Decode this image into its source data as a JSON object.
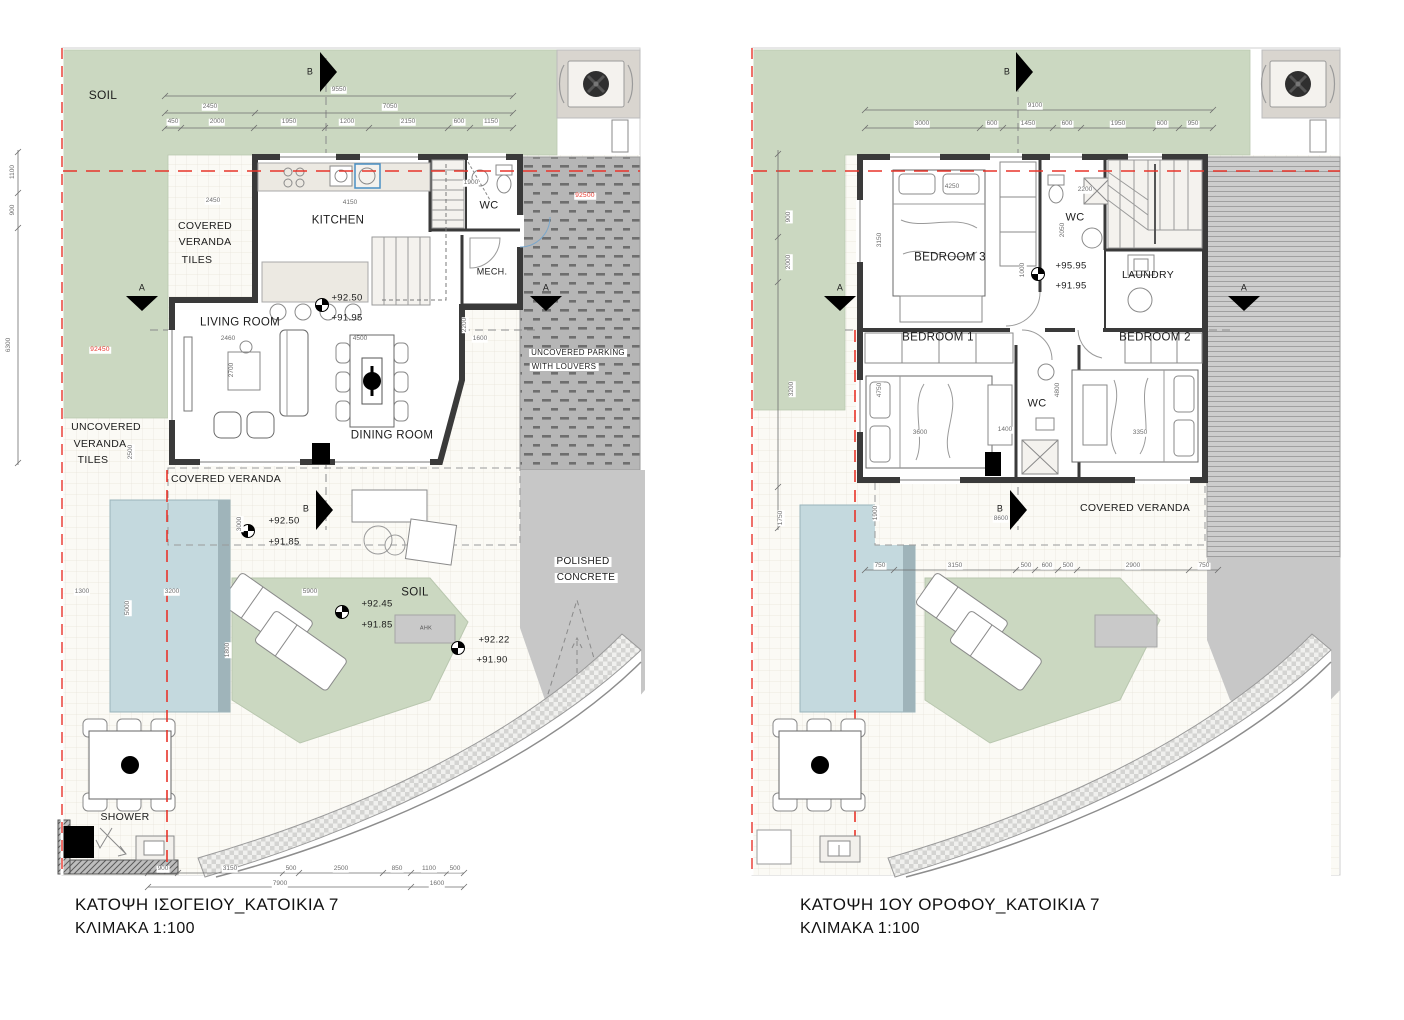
{
  "captions": {
    "left_title": "ΚΑΤΟΨΗ ΙΣΟΓΕΙΟΥ_ΚΑΤΟΙΚΙΑ 7",
    "left_scale": "ΚΛΙΜΑΚΑ 1:100",
    "right_title": "ΚΑΤΟΨΗ 1ΟΥ ΟΡΟΦΟΥ_ΚΑΤΟΙΚΙΑ 7",
    "right_scale": "ΚΛΙΜΑΚΑ 1:100"
  },
  "colors": {
    "soil_green": "#cbd8c1",
    "pool_blue": "#c4d9de",
    "parking_grey": "#b6b6b6",
    "concrete_grey": "#c7c7c7",
    "tile_bg": "#fbfaf5",
    "wall_dark": "#3a3a3a",
    "boundary_red": "#e8342a"
  },
  "labels": [
    {
      "name": "soil-label",
      "text": "SOIL",
      "x": 103,
      "y": 95,
      "size": 12
    },
    {
      "name": "covered-veranda-upper-label",
      "text": "COVERED",
      "x": 205,
      "y": 226,
      "size": 10.5
    },
    {
      "name": "covered-veranda-upper-label",
      "text": "VERANDA",
      "x": 205,
      "y": 242,
      "size": 10.5
    },
    {
      "name": "covered-veranda-upper-label",
      "text": "TILES",
      "x": 197,
      "y": 260,
      "size": 10.5
    },
    {
      "name": "kitchen-label",
      "text": "KITCHEN",
      "x": 338,
      "y": 221
    },
    {
      "name": "wc-label",
      "text": "WC",
      "x": 489,
      "y": 206,
      "size": 11
    },
    {
      "name": "mech-label",
      "text": "MECH.",
      "x": 492,
      "y": 272,
      "size": 9
    },
    {
      "name": "living-room-label",
      "text": "LIVING ROOM",
      "x": 240,
      "y": 323
    },
    {
      "name": "dining-room-label",
      "text": "DINING ROOM",
      "x": 392,
      "y": 436
    },
    {
      "name": "uncovered-veranda-label",
      "text": "UNCOVERED",
      "x": 106,
      "y": 427,
      "size": 10.5
    },
    {
      "name": "uncovered-veranda-label",
      "text": "VERANDA",
      "x": 100,
      "y": 444,
      "size": 10.5
    },
    {
      "name": "uncovered-veranda-label",
      "text": "TILES",
      "x": 93,
      "y": 460,
      "size": 10.5
    },
    {
      "name": "covered-veranda-lower-label",
      "text": "COVERED VERANDA",
      "x": 226,
      "y": 479,
      "size": 10.5
    },
    {
      "name": "parking-label",
      "text": "UNCOVERED PARKING",
      "x": 578,
      "y": 353,
      "size": 8,
      "cls": "bg"
    },
    {
      "name": "parking-label",
      "text": "WITH LOUVERS",
      "x": 564,
      "y": 367,
      "size": 8,
      "cls": "bg"
    },
    {
      "name": "polished-concrete-label",
      "text": "POLISHED",
      "x": 583,
      "y": 562,
      "size": 10,
      "cls": "bg"
    },
    {
      "name": "polished-concrete-label",
      "text": "CONCRETE",
      "x": 586,
      "y": 578,
      "size": 10,
      "cls": "bg"
    },
    {
      "name": "soil-patch-label",
      "text": "SOIL",
      "x": 415,
      "y": 593
    },
    {
      "name": "shower-label",
      "text": "SHOWER",
      "x": 125,
      "y": 817,
      "size": 10.5
    },
    {
      "name": "ahk-label",
      "text": "AHK",
      "x": 426,
      "y": 629,
      "size": 5.5,
      "color": "#555"
    },
    {
      "name": "elevation-value",
      "text": "+92.50",
      "x": 347,
      "y": 298,
      "size": 9.5
    },
    {
      "name": "elevation-value",
      "text": "+91.95",
      "x": 347,
      "y": 318,
      "size": 9.5
    },
    {
      "name": "elevation-value",
      "text": "+92.50",
      "x": 284,
      "y": 521,
      "size": 9.5
    },
    {
      "name": "elevation-value",
      "text": "+91.85",
      "x": 284,
      "y": 542,
      "size": 9.5
    },
    {
      "name": "elevation-value",
      "text": "+92.45",
      "x": 377,
      "y": 604,
      "size": 9.5
    },
    {
      "name": "elevation-value",
      "text": "+91.85",
      "x": 377,
      "y": 625,
      "size": 9.5
    },
    {
      "name": "elevation-value",
      "text": "+92.22",
      "x": 494,
      "y": 640,
      "size": 9.5
    },
    {
      "name": "elevation-value",
      "text": "+91.90",
      "x": 492,
      "y": 660,
      "size": 9.5
    },
    {
      "name": "section-letter",
      "text": "B",
      "x": 310,
      "y": 72,
      "size": 9
    },
    {
      "name": "section-letter",
      "text": "B",
      "x": 306,
      "y": 509,
      "size": 9
    },
    {
      "name": "section-letter",
      "text": "A",
      "x": 142,
      "y": 288,
      "size": 9
    },
    {
      "name": "section-letter",
      "text": "A",
      "x": 546,
      "y": 288,
      "size": 9
    },
    {
      "name": "dim-text",
      "text": "9550",
      "x": 339,
      "y": 90,
      "cls": "dim"
    },
    {
      "name": "dim-text",
      "text": "2450",
      "x": 210,
      "y": 107,
      "cls": "dim"
    },
    {
      "name": "dim-text",
      "text": "7050",
      "x": 390,
      "y": 107,
      "cls": "dim"
    },
    {
      "name": "dim-text",
      "text": "450",
      "x": 173,
      "y": 122,
      "cls": "dim"
    },
    {
      "name": "dim-text",
      "text": "2000",
      "x": 217,
      "y": 122,
      "cls": "dim"
    },
    {
      "name": "dim-text",
      "text": "1950",
      "x": 289,
      "y": 122,
      "cls": "dim"
    },
    {
      "name": "dim-text",
      "text": "1200",
      "x": 347,
      "y": 122,
      "cls": "dim"
    },
    {
      "name": "dim-text",
      "text": "2150",
      "x": 408,
      "y": 122,
      "cls": "dim"
    },
    {
      "name": "dim-text",
      "text": "600",
      "x": 459,
      "y": 122,
      "cls": "dim"
    },
    {
      "name": "dim-text",
      "text": "1150",
      "x": 491,
      "y": 122,
      "cls": "dim"
    },
    {
      "name": "dim-text",
      "text": "900",
      "x": 163,
      "y": 869,
      "cls": "dim"
    },
    {
      "name": "dim-text",
      "text": "3150",
      "x": 230,
      "y": 869,
      "cls": "dim"
    },
    {
      "name": "dim-text",
      "text": "500",
      "x": 291,
      "y": 869,
      "cls": "dim"
    },
    {
      "name": "dim-text",
      "text": "2500",
      "x": 341,
      "y": 869,
      "cls": "dim"
    },
    {
      "name": "dim-text",
      "text": "850",
      "x": 397,
      "y": 869,
      "cls": "dim"
    },
    {
      "name": "dim-text",
      "text": "1100",
      "x": 429,
      "y": 869,
      "cls": "dim"
    },
    {
      "name": "dim-text",
      "text": "500",
      "x": 455,
      "y": 869,
      "cls": "dim"
    },
    {
      "name": "dim-text",
      "text": "7900",
      "x": 280,
      "y": 884,
      "cls": "dim"
    },
    {
      "name": "dim-text",
      "text": "1600",
      "x": 437,
      "y": 884,
      "cls": "dim"
    },
    {
      "name": "dim-text",
      "text": "1100",
      "x": 13,
      "y": 172,
      "cls": "dim",
      "rot": -90
    },
    {
      "name": "dim-text",
      "text": "900",
      "x": 13,
      "y": 210,
      "cls": "dim",
      "rot": -90
    },
    {
      "name": "dim-text",
      "text": "6300",
      "x": 9,
      "y": 345,
      "cls": "dim",
      "rot": -90
    },
    {
      "name": "survey-ref",
      "text": "92450",
      "x": 100,
      "y": 350,
      "cls": "red"
    },
    {
      "name": "survey-ref",
      "text": "92500",
      "x": 585,
      "y": 196,
      "cls": "red"
    },
    {
      "name": "dim-text",
      "text": "2450",
      "x": 213,
      "y": 201,
      "cls": "dim"
    },
    {
      "name": "dim-text",
      "text": "4150",
      "x": 350,
      "y": 203,
      "cls": "dim"
    },
    {
      "name": "dim-text",
      "text": "1900",
      "x": 471,
      "y": 183,
      "cls": "dim"
    },
    {
      "name": "dim-text",
      "text": "3000",
      "x": 240,
      "y": 524,
      "cls": "dim",
      "rot": -90
    },
    {
      "name": "dim-text",
      "text": "2500",
      "x": 131,
      "y": 452,
      "cls": "dim",
      "rot": -90
    },
    {
      "name": "dim-text",
      "text": "2460",
      "x": 228,
      "y": 339,
      "cls": "dim"
    },
    {
      "name": "dim-text",
      "text": "2700",
      "x": 232,
      "y": 370,
      "cls": "dim",
      "rot": -90
    },
    {
      "name": "dim-text",
      "text": "4500",
      "x": 360,
      "y": 339,
      "cls": "dim"
    },
    {
      "name": "dim-text",
      "text": "1600",
      "x": 480,
      "y": 339,
      "cls": "dim"
    },
    {
      "name": "dim-text",
      "text": "2200",
      "x": 465,
      "y": 325,
      "cls": "dim",
      "rot": -90
    },
    {
      "name": "dim-text",
      "text": "5900",
      "x": 310,
      "y": 592,
      "cls": "dim"
    },
    {
      "name": "dim-text",
      "text": "3200",
      "x": 172,
      "y": 592,
      "cls": "dim"
    },
    {
      "name": "dim-text",
      "text": "5000",
      "x": 128,
      "y": 608,
      "cls": "dim",
      "rot": -90
    },
    {
      "name": "dim-text",
      "text": "1300",
      "x": 82,
      "y": 592,
      "cls": "dim"
    },
    {
      "name": "dim-text",
      "text": "1800",
      "x": 228,
      "y": 650,
      "cls": "dim",
      "rot": -90
    },
    {
      "name": "bedroom3-label",
      "text": "BEDROOM 3",
      "x": 950,
      "y": 258
    },
    {
      "name": "wc-label",
      "text": "WC",
      "x": 1075,
      "y": 218,
      "size": 11
    },
    {
      "name": "laundry-label",
      "text": "LAUNDRY",
      "x": 1148,
      "y": 275,
      "size": 10.5
    },
    {
      "name": "bedroom1-label",
      "text": "BEDROOM 1",
      "x": 938,
      "y": 338
    },
    {
      "name": "bedroom2-label",
      "text": "BEDROOM 2",
      "x": 1155,
      "y": 338
    },
    {
      "name": "wc-label",
      "text": "WC",
      "x": 1037,
      "y": 404,
      "size": 11
    },
    {
      "name": "covered-veranda-label",
      "text": "COVERED VERANDA",
      "x": 1135,
      "y": 508,
      "size": 10.5
    },
    {
      "name": "elevation-value",
      "text": "+95.95",
      "x": 1071,
      "y": 266,
      "size": 9.5,
      "cls": "bg"
    },
    {
      "name": "elevation-value",
      "text": "+91.95",
      "x": 1071,
      "y": 286,
      "size": 9.5,
      "cls": "bg"
    },
    {
      "name": "section-letter",
      "text": "B",
      "x": 1007,
      "y": 72,
      "size": 9
    },
    {
      "name": "section-letter",
      "text": "B",
      "x": 1000,
      "y": 509,
      "size": 9
    },
    {
      "name": "section-letter",
      "text": "A",
      "x": 840,
      "y": 288,
      "size": 9
    },
    {
      "name": "section-letter",
      "text": "A",
      "x": 1244,
      "y": 288,
      "size": 9
    },
    {
      "name": "dim-text",
      "text": "9100",
      "x": 1035,
      "y": 106,
      "cls": "dim"
    },
    {
      "name": "dim-text",
      "text": "3000",
      "x": 922,
      "y": 124,
      "cls": "dim"
    },
    {
      "name": "dim-text",
      "text": "600",
      "x": 992,
      "y": 124,
      "cls": "dim"
    },
    {
      "name": "dim-text",
      "text": "1450",
      "x": 1028,
      "y": 124,
      "cls": "dim"
    },
    {
      "name": "dim-text",
      "text": "600",
      "x": 1067,
      "y": 124,
      "cls": "dim"
    },
    {
      "name": "dim-text",
      "text": "1950",
      "x": 1118,
      "y": 124,
      "cls": "dim"
    },
    {
      "name": "dim-text",
      "text": "600",
      "x": 1162,
      "y": 124,
      "cls": "dim"
    },
    {
      "name": "dim-text",
      "text": "950",
      "x": 1193,
      "y": 124,
      "cls": "dim"
    },
    {
      "name": "dim-text",
      "text": "750",
      "x": 880,
      "y": 566,
      "cls": "dim"
    },
    {
      "name": "dim-text",
      "text": "3150",
      "x": 955,
      "y": 566,
      "cls": "dim"
    },
    {
      "name": "dim-text",
      "text": "500",
      "x": 1026,
      "y": 566,
      "cls": "dim"
    },
    {
      "name": "dim-text",
      "text": "600",
      "x": 1047,
      "y": 566,
      "cls": "dim"
    },
    {
      "name": "dim-text",
      "text": "500",
      "x": 1068,
      "y": 566,
      "cls": "dim"
    },
    {
      "name": "dim-text",
      "text": "2900",
      "x": 1133,
      "y": 566,
      "cls": "dim"
    },
    {
      "name": "dim-text",
      "text": "750",
      "x": 1204,
      "y": 566,
      "cls": "dim"
    },
    {
      "name": "dim-text",
      "text": "900",
      "x": 789,
      "y": 217,
      "cls": "dim",
      "rot": -90
    },
    {
      "name": "dim-text",
      "text": "2000",
      "x": 789,
      "y": 262,
      "cls": "dim",
      "rot": -90
    },
    {
      "name": "dim-text",
      "text": "3200",
      "x": 792,
      "y": 389,
      "cls": "dim",
      "rot": -90
    },
    {
      "name": "dim-text",
      "text": "1750",
      "x": 781,
      "y": 518,
      "cls": "dim",
      "rot": -90
    },
    {
      "name": "dim-text",
      "text": "4250",
      "x": 952,
      "y": 187,
      "cls": "dim"
    },
    {
      "name": "dim-text",
      "text": "3150",
      "x": 880,
      "y": 240,
      "cls": "dim",
      "rot": -90
    },
    {
      "name": "dim-text",
      "text": "2200",
      "x": 1085,
      "y": 190,
      "cls": "dim"
    },
    {
      "name": "dim-text",
      "text": "2050",
      "x": 1063,
      "y": 230,
      "cls": "dim",
      "rot": -90
    },
    {
      "name": "dim-text",
      "text": "1000",
      "x": 1023,
      "y": 270,
      "cls": "dim",
      "rot": -90
    },
    {
      "name": "dim-text",
      "text": "1400",
      "x": 1005,
      "y": 430,
      "cls": "dim"
    },
    {
      "name": "dim-text",
      "text": "3600",
      "x": 920,
      "y": 433,
      "cls": "dim"
    },
    {
      "name": "dim-text",
      "text": "3350",
      "x": 1140,
      "y": 433,
      "cls": "dim"
    },
    {
      "name": "dim-text",
      "text": "4750",
      "x": 880,
      "y": 390,
      "cls": "dim",
      "rot": -90
    },
    {
      "name": "dim-text",
      "text": "4800",
      "x": 1058,
      "y": 390,
      "cls": "dim",
      "rot": -90
    },
    {
      "name": "dim-text",
      "text": "8600",
      "x": 1001,
      "y": 519,
      "cls": "dim"
    },
    {
      "name": "dim-text",
      "text": "1900",
      "x": 876,
      "y": 513,
      "cls": "dim",
      "rot": -90
    }
  ]
}
